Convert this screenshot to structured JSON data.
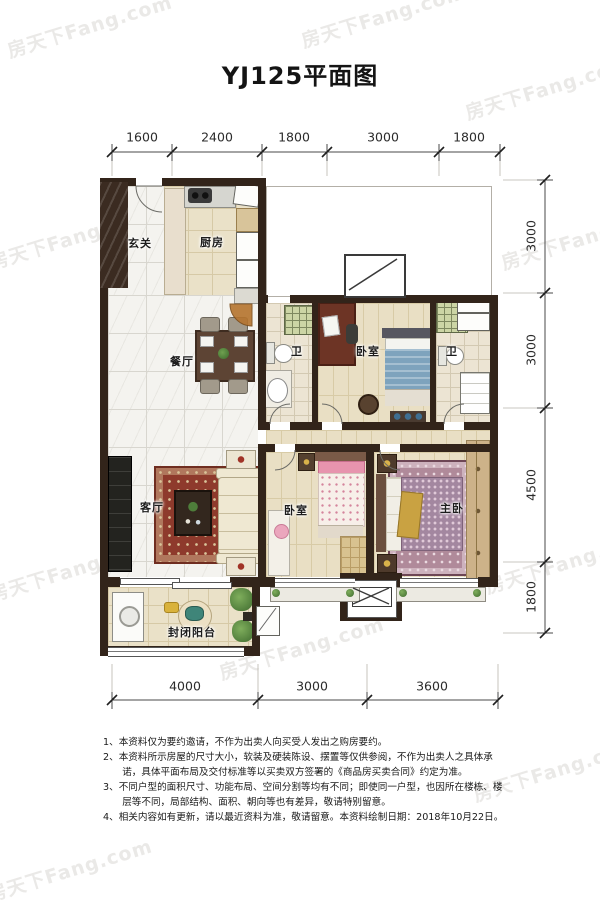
{
  "title": "YJ125平面图",
  "watermark": {
    "text": "房天下Fang.com"
  },
  "dimensions": {
    "top": [
      "1600",
      "2400",
      "1800",
      "3000",
      "1800"
    ],
    "right": [
      "3000",
      "3000",
      "4500",
      "1800"
    ],
    "bottom": [
      "4000",
      "3000",
      "3600"
    ]
  },
  "rooms": {
    "entry": "玄关",
    "kitchen": "厨房",
    "dining": "餐厅",
    "bath1": "卫",
    "bedroom1": "卧室",
    "bath2": "卫",
    "living": "客厅",
    "bedroom2": "卧室",
    "master": "主卧",
    "balcony": "封闭阳台"
  },
  "notes": [
    "1、本资料仅为要约邀请，不作为出卖人向买受人发出之购房要约。",
    "2、本资料所示房屋的尺寸大小，软装及硬装陈设、摆置等仅供参阅，不作为出卖人之具体承诺，具体平面布局及交付标准等以买卖双方签署的《商品房买卖合同》约定为准。",
    "3、不同户型的面积尺寸、功能布局、空间分割等均有不同；即使同一户型，也因所在楼栋、楼层等不同，局部结构、面积、朝向等也有差异，敬请特别留意。",
    "4、相关内容如有更新，请以最近资料为准，敬请留意。本资料绘制日期：2018年10月22日。"
  ],
  "colors": {
    "wall": "#32241a",
    "marble_floor": "#f4f3ef",
    "wood_floor": "#e9dfc4",
    "living_rug": "#8e3a2c",
    "master_rug": "#b08a9a",
    "bed_blue": "#7ea3bd",
    "bed_pink": "#e794ae",
    "shower": "#ccd5a5",
    "door_fan": "#b5742e"
  }
}
